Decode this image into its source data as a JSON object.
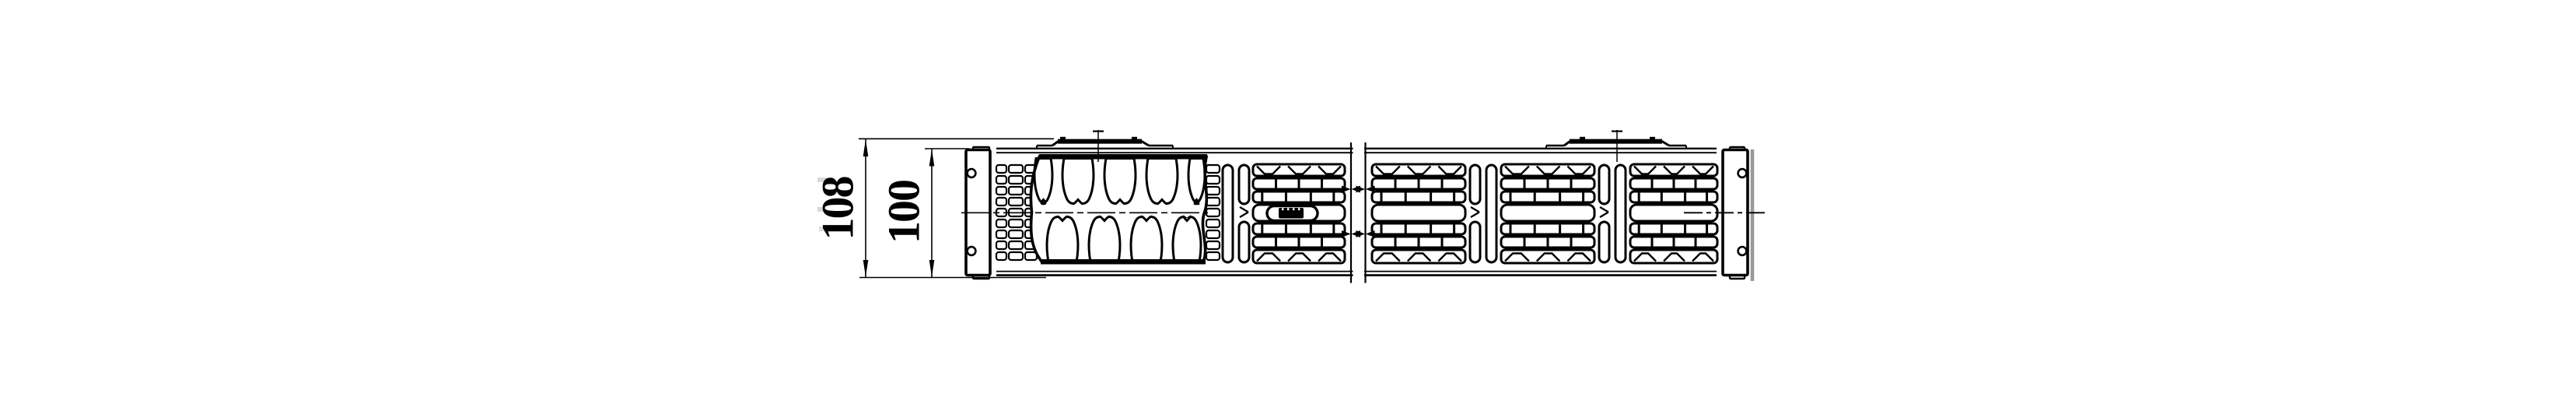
{
  "dimensions": {
    "outer": {
      "label": "108"
    },
    "inner": {
      "label": "100"
    }
  },
  "colors": {
    "background": "#ffffff",
    "ink": "#000000",
    "shadow": "#999999",
    "badge_fill": "#000000",
    "artifact": "#c8c8c8"
  }
}
